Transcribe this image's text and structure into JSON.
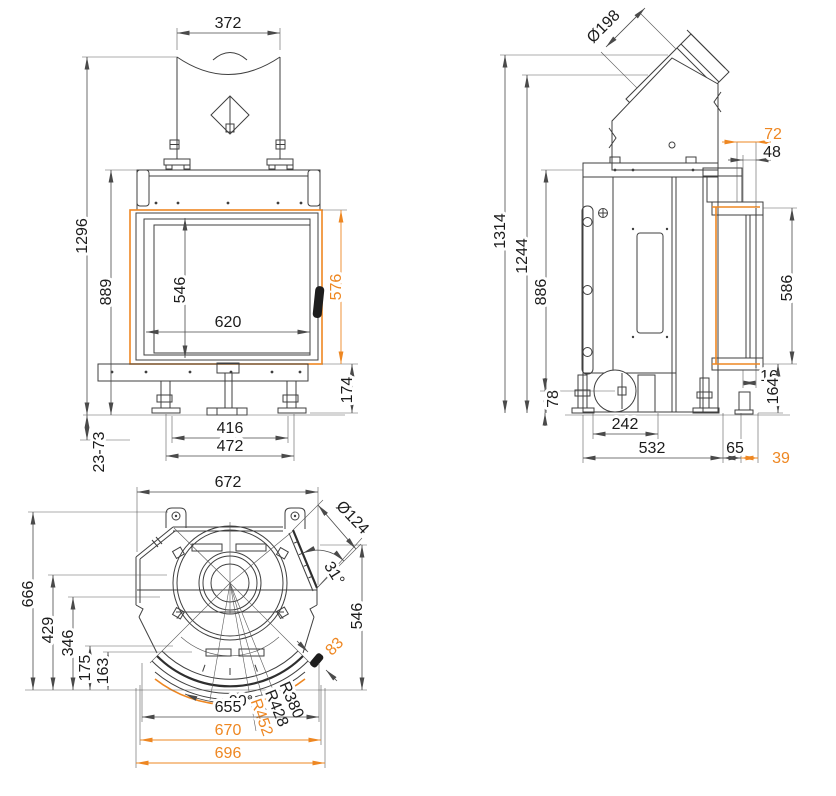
{
  "colors": {
    "line": "#3f3f3f",
    "dim": "#4a4a4a",
    "accent": "#ee8722",
    "background": "#ffffff"
  },
  "front": {
    "flue_width": "372",
    "overall_height": "1296",
    "body_height": "889",
    "glass_height": "546",
    "glass_width": "620",
    "door_height": "576",
    "plinth_height": "174",
    "feet_inner": "416",
    "feet_outer": "472",
    "leg_range": "23-73"
  },
  "side": {
    "flue_diameter": "Ø198",
    "offset_72": "72",
    "offset_48": "48",
    "overall_height": "1314",
    "collar_height": "1244",
    "body_height": "886",
    "glass_height": "586",
    "offset_16": "16",
    "plinth_height": "164",
    "inlet_height": "78",
    "inlet_offset": "242",
    "depth": "532",
    "offset_65": "65",
    "offset_39": "39"
  },
  "top": {
    "width": "672",
    "inlet_diameter": "Ø124",
    "corner_angle": "31°",
    "depth_total": "666",
    "depth_429": "429",
    "depth_346": "346",
    "depth_175": "175",
    "depth_163": "163",
    "depth_546": "546",
    "handle_offset": "83",
    "glass_angle": "90°",
    "radius_r380": "R380",
    "radius_r428": "R428",
    "radius_r452": "R452",
    "width_655": "655",
    "width_670": "670",
    "width_696": "696"
  }
}
